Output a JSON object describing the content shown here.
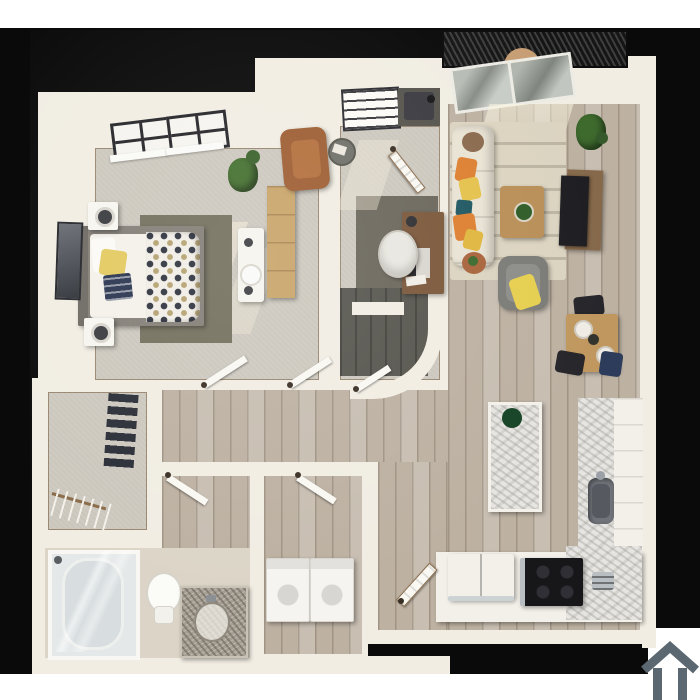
{
  "scene": {
    "kind": "3d-rendered-apartment-floor-plan",
    "background_color": "#0a0a0a",
    "page_background": "#ffffff"
  },
  "palette": {
    "wall_white": "#f1ede3",
    "carpet_gray": "#cac6bc",
    "wood_floor": "#bdb1a2",
    "accent_rug_dark": "#6b675c",
    "bedroom_rug_olive": "#74705e",
    "granite": "#e7e5e1",
    "balcony_grate": "#151515",
    "logo_gray": "#5b6771",
    "sofa_beige": "#e9e3d4",
    "pillow_orange": "#dd8031",
    "pillow_yellow": "#e4c24d",
    "pillow_teal": "#1f5862",
    "leather_chair_brown": "#9e5e33",
    "wood_furniture": "#c0985f",
    "tv_black": "#1e1e22",
    "appliance_white": "#f5f4f0",
    "stainless_steel": "#b9bfc3",
    "plant_green": "#3e6a2e",
    "navy_textile": "#2b3550"
  },
  "rooms": {
    "bedroom": {
      "label": "Bedroom"
    },
    "den": {
      "label": "Den / Office"
    },
    "living_room": {
      "label": "Living Room"
    },
    "dining_area": {
      "label": "Dining Area"
    },
    "kitchen": {
      "label": "Kitchen"
    },
    "hallway": {
      "label": "Hallway"
    },
    "walk_in_closet": {
      "label": "Walk-in Closet"
    },
    "bathroom": {
      "label": "Bathroom"
    },
    "laundry": {
      "label": "Laundry Closet"
    },
    "balcony": {
      "label": "Balcony"
    },
    "entry": {
      "label": "Entry"
    },
    "stair_alcove": {
      "label": "Stair / Utility Alcove"
    }
  },
  "furniture": {
    "bed": "Bed with polka-dot duvet",
    "nightstand": "Nightstand with lamp",
    "dresser": "Dresser",
    "vanity_desk": "Vanity desk & stool",
    "wall_art": "Framed wall art",
    "windows": "Bedroom windows",
    "plant": "Potted plant",
    "shelf_closet": "Linen shelves",
    "water_heater": "Water heater",
    "leather_armchair": "Leather armchair",
    "side_table": "Round side table",
    "desk": "Desk with laptop",
    "office_chair": "Office chair",
    "sliding_door": "Sliding glass door",
    "balcony_chair": "Balcony chair",
    "sofa": "Sofa with pillows",
    "area_rug": "Patterned area rug",
    "coffee_table": "Coffee table",
    "tv": "TV & media stand",
    "accent_chair": "Accent chair with throw",
    "dining_set": "Dining table & chairs",
    "island": "Kitchen island",
    "counter": "Kitchen counter",
    "sink": "Kitchen sink",
    "stove": "Range cooktop",
    "fridge": "Refrigerator",
    "toaster": "Toaster",
    "washer_dryer": "Washer & dryer",
    "shower": "Glass shower",
    "toilet": "Toilet",
    "bath_vanity": "Granite vanity",
    "shoe_rack": "Shoe rack",
    "hanging_rod": "Hanging rod with hangers",
    "front_door": "Entry door",
    "interior_door": "Interior door"
  },
  "branding": {
    "logo_alt": "House outline logo watermark"
  }
}
